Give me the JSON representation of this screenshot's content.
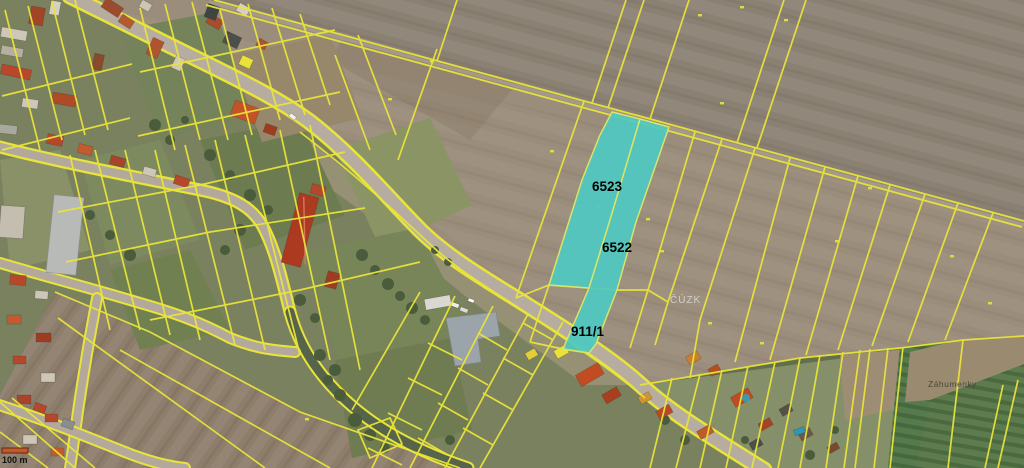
{
  "map": {
    "type": "cadastral-aerial-view",
    "labels": {
      "parcel_a": "6523",
      "parcel_b": "6522",
      "parcel_c": "911/1",
      "place": "Záhumenky",
      "watermark": "ČÚZK",
      "scale": "100 m"
    },
    "colors": {
      "highlight": "#4ec9c1",
      "parcel_line": "#e9e43a",
      "road": "#b6ada0",
      "scale_bar": "#c05a2a"
    }
  }
}
